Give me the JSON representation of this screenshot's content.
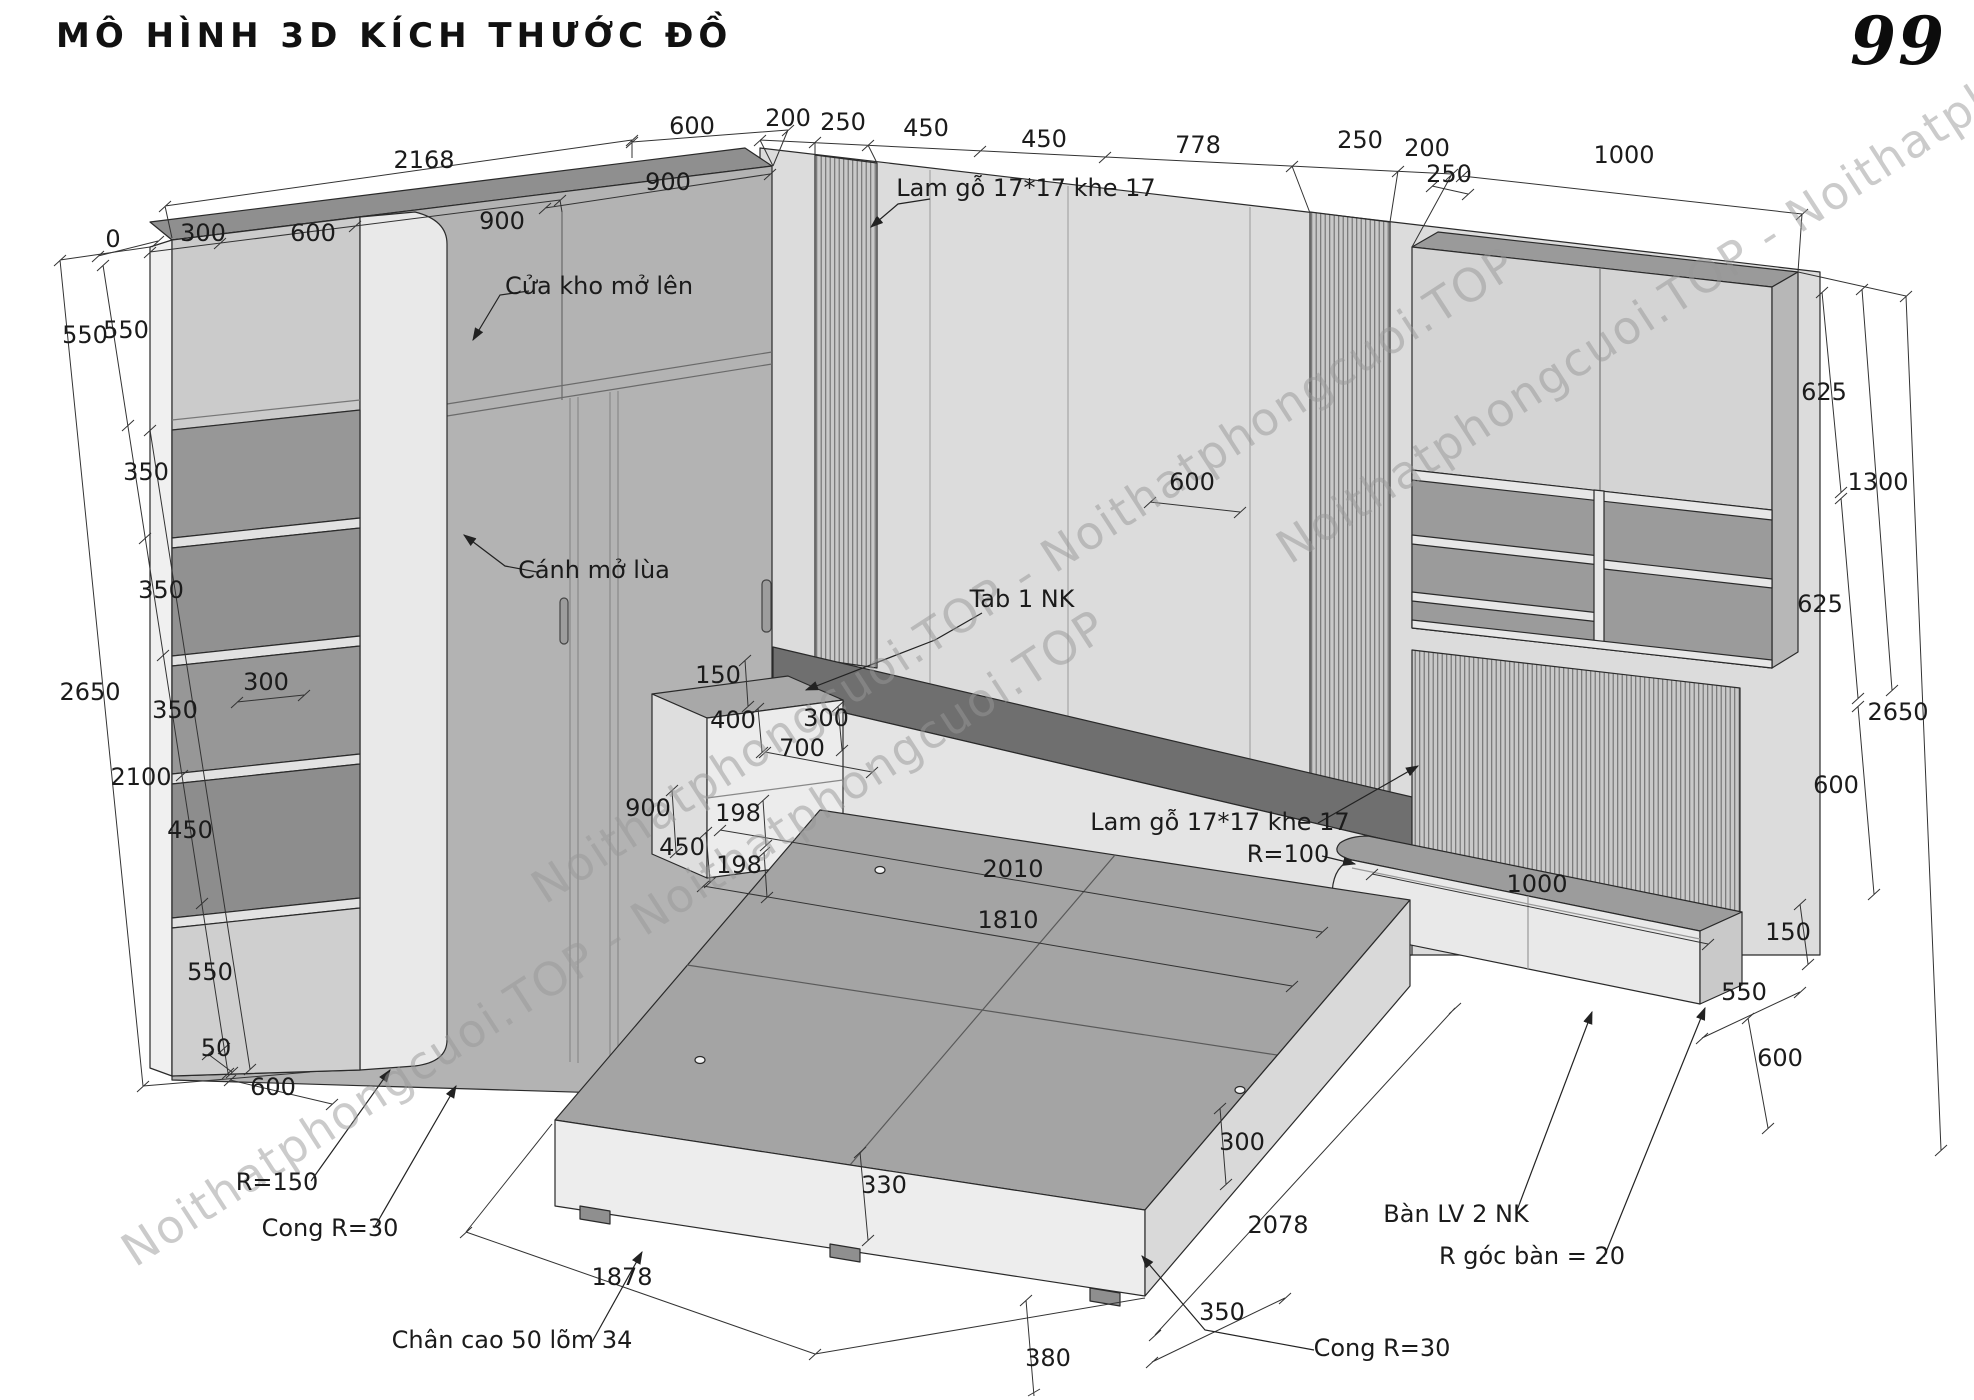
{
  "page": {
    "title": "MÔ HÌNH 3D KÍCH THƯỚC ĐỒ",
    "page_number": "99"
  },
  "watermark": {
    "text": "Noithatphongcuoi.TOP - Noithatphongcuoi.TOP"
  },
  "drawing": {
    "units": "mm",
    "dimensions": [
      {
        "t": "2168",
        "x": 424,
        "y": 168
      },
      {
        "t": "300",
        "x": 203,
        "y": 241
      },
      {
        "t": "600",
        "x": 313,
        "y": 241
      },
      {
        "t": "900",
        "x": 502,
        "y": 229
      },
      {
        "t": "900",
        "x": 668,
        "y": 190
      },
      {
        "t": "600",
        "x": 692,
        "y": 134
      },
      {
        "t": "200",
        "x": 788,
        "y": 126
      },
      {
        "t": "250",
        "x": 843,
        "y": 130
      },
      {
        "t": "450",
        "x": 926,
        "y": 136
      },
      {
        "t": "450",
        "x": 1044,
        "y": 147
      },
      {
        "t": "778",
        "x": 1198,
        "y": 153
      },
      {
        "t": "250",
        "x": 1360,
        "y": 148
      },
      {
        "t": "200",
        "x": 1427,
        "y": 156
      },
      {
        "t": "250",
        "x": 1449,
        "y": 182
      },
      {
        "t": "1000",
        "x": 1624,
        "y": 163
      },
      {
        "t": "0",
        "x": 113,
        "y": 247
      },
      {
        "t": "550",
        "x": 85,
        "y": 343
      },
      {
        "t": "550",
        "x": 126,
        "y": 338
      },
      {
        "t": "350",
        "x": 146,
        "y": 480
      },
      {
        "t": "350",
        "x": 161,
        "y": 598
      },
      {
        "t": "300",
        "x": 266,
        "y": 690
      },
      {
        "t": "2650",
        "x": 90,
        "y": 700
      },
      {
        "t": "350",
        "x": 175,
        "y": 718
      },
      {
        "t": "2100",
        "x": 141,
        "y": 785
      },
      {
        "t": "450",
        "x": 190,
        "y": 838
      },
      {
        "t": "550",
        "x": 210,
        "y": 980
      },
      {
        "t": "50",
        "x": 216,
        "y": 1056
      },
      {
        "t": "600",
        "x": 273,
        "y": 1095
      },
      {
        "t": "150",
        "x": 718,
        "y": 683
      },
      {
        "t": "400",
        "x": 733,
        "y": 728
      },
      {
        "t": "300",
        "x": 826,
        "y": 726
      },
      {
        "t": "700",
        "x": 802,
        "y": 756
      },
      {
        "t": "900",
        "x": 648,
        "y": 816
      },
      {
        "t": "198",
        "x": 738,
        "y": 821
      },
      {
        "t": "450",
        "x": 682,
        "y": 855
      },
      {
        "t": "198",
        "x": 739,
        "y": 873
      },
      {
        "t": "2010",
        "x": 1013,
        "y": 877
      },
      {
        "t": "1810",
        "x": 1008,
        "y": 928
      },
      {
        "t": "330",
        "x": 884,
        "y": 1193
      },
      {
        "t": "380",
        "x": 1048,
        "y": 1366
      },
      {
        "t": "350",
        "x": 1222,
        "y": 1320
      },
      {
        "t": "2078",
        "x": 1278,
        "y": 1233
      },
      {
        "t": "300",
        "x": 1242,
        "y": 1150
      },
      {
        "t": "1878",
        "x": 622,
        "y": 1285
      },
      {
        "t": "625",
        "x": 1824,
        "y": 400
      },
      {
        "t": "1300",
        "x": 1878,
        "y": 490
      },
      {
        "t": "625",
        "x": 1820,
        "y": 612
      },
      {
        "t": "2650",
        "x": 1898,
        "y": 720
      },
      {
        "t": "600",
        "x": 1836,
        "y": 793
      },
      {
        "t": "600",
        "x": 1192,
        "y": 490
      },
      {
        "t": "1000",
        "x": 1537,
        "y": 892
      },
      {
        "t": "150",
        "x": 1788,
        "y": 940
      },
      {
        "t": "550",
        "x": 1744,
        "y": 1000
      },
      {
        "t": "600",
        "x": 1780,
        "y": 1066
      }
    ],
    "notes": [
      {
        "t": "Lam gỗ 17*17 khe 17",
        "x": 1026,
        "y": 196
      },
      {
        "t": "Cửa kho mở lên",
        "x": 599,
        "y": 294
      },
      {
        "t": "Cánh mở lùa",
        "x": 594,
        "y": 578
      },
      {
        "t": "Tab 1 NK",
        "x": 1022,
        "y": 607
      },
      {
        "t": "Lam gỗ 17*17 khe 17",
        "x": 1220,
        "y": 830
      },
      {
        "t": "R=100",
        "x": 1288,
        "y": 862
      },
      {
        "t": "R=150",
        "x": 277,
        "y": 1190
      },
      {
        "t": "Cong R=30",
        "x": 330,
        "y": 1236
      },
      {
        "t": "Chân cao 50 lõm 34",
        "x": 512,
        "y": 1348
      },
      {
        "t": "Cong R=30",
        "x": 1382,
        "y": 1356
      },
      {
        "t": "Bàn LV 2 NK",
        "x": 1456,
        "y": 1222
      },
      {
        "t": "R góc bàn = 20",
        "x": 1532,
        "y": 1264
      }
    ]
  }
}
